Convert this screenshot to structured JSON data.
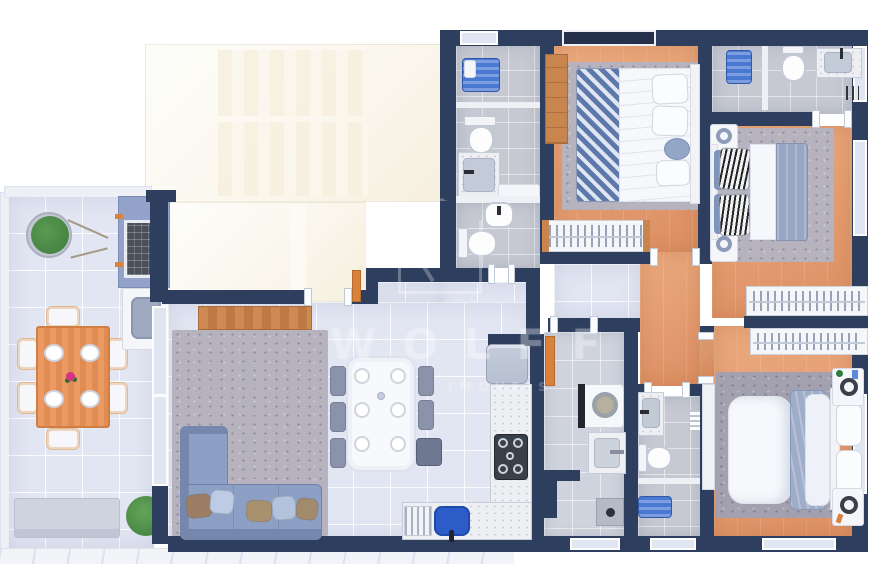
{
  "meta": {
    "title": "Apartment floor plan - top-down 3D architectural render",
    "render_type": "furnished floor plan, no text labels"
  },
  "watermark": {
    "brand": "WOLFF",
    "tagline": "IMÓVEIS",
    "logo": "house-outline-logo"
  },
  "palette": {
    "wall": "#2e3e5e",
    "wood": "#eaaa7e",
    "wood2": "#dd9064",
    "furnwood": "#c9854e",
    "tilebath": "#c6c9d2",
    "tilelt": "#e2e5f2",
    "tilelaundry": "#cfd3dd",
    "rug": "#b6b3bf",
    "rugdk": "#a3a0af",
    "sofa": "#8c9fc4",
    "sofadk": "#7587ad",
    "white": "#f5f6fa",
    "marble": "#edeff3",
    "blue": "#2b5cc8",
    "bluemat": "#4a79d4",
    "steel": "#b7c0d0",
    "plant": "#3f7d3c",
    "cream": "#f6efdd",
    "cream2": "#faf6ec",
    "navyglass": "#25304a",
    "orange": "#d9823e",
    "grillface": "#4a4f58",
    "grillsurround": "#93a2c8",
    "glass": "#dfe6f2",
    "chairgray": "#8a93aa",
    "watermark": "rgba(255,255,255,0.25)"
  },
  "rooms": [
    {
      "name": "terrace-gourmet",
      "features": [
        "outdoor-wood-dining-table",
        "six-white-chairs",
        "potted-plant",
        "bench",
        "barbecue-grill",
        "outdoor-sink",
        "marble-border"
      ]
    },
    {
      "name": "living-room",
      "features": [
        "l-shaped-blue-gray-sofa",
        "five-throw-pillows",
        "concrete-look-rug",
        "wooden-sideboard",
        "glass-slider-to-terrace"
      ]
    },
    {
      "name": "dining-area",
      "features": [
        "white-dining-table",
        "six-place-settings",
        "five-gray-chairs",
        "dark-bench"
      ]
    },
    {
      "name": "kitchen",
      "features": [
        "refrigerator",
        "marble-counter",
        "cooktop",
        "blue-sink",
        "dish-rack",
        "orange-open-door"
      ]
    },
    {
      "name": "laundry-area",
      "features": [
        "washing-machine",
        "utility-sink",
        "floor-drain"
      ]
    },
    {
      "name": "bathroom-1",
      "features": [
        "shower-with-blue-mat",
        "toilet",
        "marble-vanity",
        "shelf"
      ]
    },
    {
      "name": "powder-room",
      "features": [
        "washbasin",
        "toilet"
      ]
    },
    {
      "name": "bedroom-1",
      "features": [
        "double-bed-striped-blanket",
        "white-pillows",
        "headboard",
        "wood-dresser",
        "open-wardrobe-with-hangers",
        "gray-rug",
        "dark-window"
      ]
    },
    {
      "name": "bathroom-2",
      "features": [
        "shower-with-blue-mat",
        "toilet",
        "marble-vanity",
        "towel-rail"
      ]
    },
    {
      "name": "bedroom-2",
      "features": [
        "double-bed",
        "zebra-print-pillows",
        "gray-blanket",
        "two-nightstands-with-lamps",
        "open-wardrobe-with-hangers",
        "gray-rug"
      ]
    },
    {
      "name": "bathroom-3",
      "features": [
        "marble-vanity",
        "toilet",
        "shower-with-blue-mat",
        "towel-rail"
      ]
    },
    {
      "name": "bedroom-3",
      "features": [
        "double-bed",
        "gray-duvet",
        "headboard-pillows",
        "two-nightstands-with-lamps",
        "open-wardrobe-with-hangers",
        "white-wall-cabinet",
        "gray-rug"
      ]
    },
    {
      "name": "hallway",
      "features": [
        "tile-and-wood-floor",
        "door-openings"
      ]
    },
    {
      "name": "unbuilt-roof-area",
      "features": [
        "cream-white-panels"
      ]
    }
  ]
}
